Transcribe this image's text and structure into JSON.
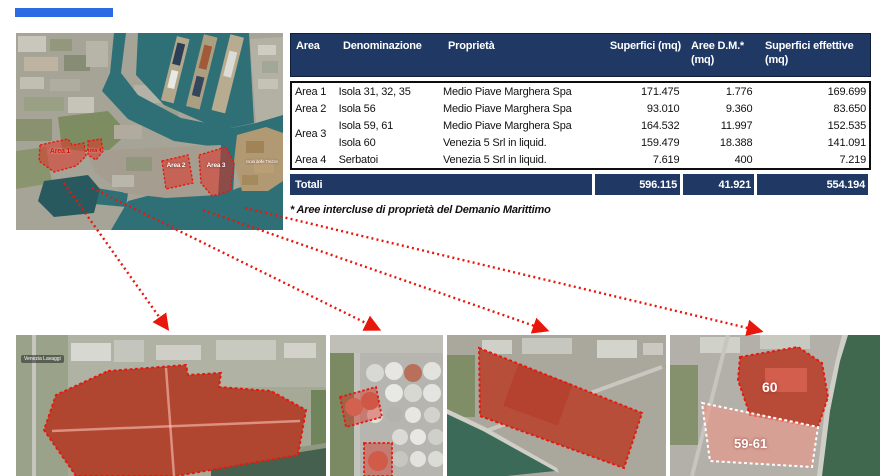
{
  "colors": {
    "accent_blue": "#2b6be4",
    "table_header_bg": "#1f3864",
    "highlight_red": "#e8170b",
    "water_teal": "#2f7077"
  },
  "map": {
    "labels": {
      "area1": "Area 1",
      "area2": "Area 2",
      "area3": "Area 3",
      "area4": "Area 4",
      "island": "Isola delle Trezze"
    }
  },
  "table": {
    "columns": [
      {
        "line1": "Area",
        "line2": ""
      },
      {
        "line1": "Denominazione",
        "line2": ""
      },
      {
        "line1": "Proprietà",
        "line2": ""
      },
      {
        "line1": "Superfici (mq)",
        "line2": ""
      },
      {
        "line1": "Aree D.M.*",
        "line2": "(mq)"
      },
      {
        "line1": "Superfici effettive",
        "line2": "(mq)"
      }
    ],
    "rows": [
      {
        "area": "Area 1",
        "denominazione": "Isola 31, 32, 35",
        "proprieta": "Medio Piave Marghera Spa",
        "superfici": "171.475",
        "aree_dm": "1.776",
        "superfici_effettive": "169.699"
      },
      {
        "area": "Area 2",
        "denominazione": "Isola 56",
        "proprieta": "Medio Piave Marghera Spa",
        "superfici": "93.010",
        "aree_dm": "9.360",
        "superfici_effettive": "83.650"
      },
      {
        "area": "Area 3",
        "denominazione": "Isola 59, 61",
        "proprieta": "Medio Piave Marghera Spa",
        "superfici": "164.532",
        "aree_dm": "11.997",
        "superfici_effettive": "152.535"
      },
      {
        "area": "",
        "denominazione": "Isola 60",
        "proprieta": "Venezia 5 Srl in liquid.",
        "superfici": "159.479",
        "aree_dm": "18.388",
        "superfici_effettive": "141.091"
      },
      {
        "area": "Area 4",
        "denominazione": "Serbatoi",
        "proprieta": "Venezia 5 Srl in liquid.",
        "superfici": "7.619",
        "aree_dm": "400",
        "superfici_effettive": "7.219"
      }
    ],
    "totals": {
      "label": "Totali",
      "superfici": "596.115",
      "aree_dm": "41.921",
      "superfici_effettive": "554.194"
    },
    "footnote": "* Aree intercluse di proprietà del Demanio Marittimo"
  },
  "detail_labels": {
    "place": "Venezia Lavaggi",
    "area60": "60",
    "area5961": "59-61"
  }
}
